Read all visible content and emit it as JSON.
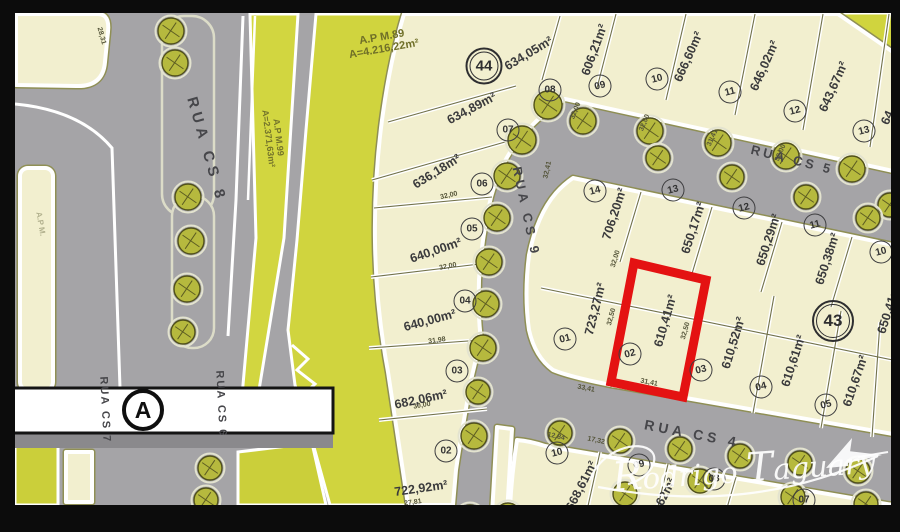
{
  "title": "Loteamento site plan with lot 02 (610,41 m2) highlighted",
  "colors": {
    "paper_cream": "#f2efcf",
    "green_area": "#d0d43e",
    "street_gray": "#a5a4a7",
    "highlight_red": "#e41212",
    "frame_black": "#0c0c0c",
    "tree_olive": "#b6b93e",
    "text_dark": "#3a3a3c"
  },
  "annotations": [
    {
      "id": "ap-m89",
      "lines": [
        "A.P M.89",
        "A=4.216,22m²"
      ],
      "x": 383,
      "y": 44,
      "rot": -10,
      "size": 11,
      "color": "#6f6f28",
      "opacity": 1
    },
    {
      "id": "ap-m99",
      "lines": [
        "A.P M.99",
        "A=2.371,63m²"
      ],
      "x": 273,
      "y": 138,
      "rot": 83,
      "size": 9,
      "color": "#73732b",
      "opacity": 1
    },
    {
      "id": "ap-left",
      "lines": [
        "A.P M."
      ],
      "x": 40,
      "y": 224,
      "rot": 80,
      "size": 8,
      "color": "#7d7d58",
      "opacity": 0.55
    }
  ],
  "streets": [
    {
      "name": "RUA CS 8",
      "x": 206,
      "y": 150,
      "rot": 74,
      "size": 15,
      "ls": 5
    },
    {
      "name": "RUA CS 9",
      "x": 526,
      "y": 212,
      "rot": 78,
      "size": 13,
      "ls": 4
    },
    {
      "name": "RUA CS 5",
      "x": 792,
      "y": 160,
      "rot": 14,
      "size": 13,
      "ls": 3
    },
    {
      "name": "RUA CS 4",
      "x": 692,
      "y": 434,
      "rot": 11,
      "size": 14,
      "ls": 4
    },
    {
      "name": "RUA CS 7",
      "x": 104,
      "y": 410,
      "rot": 87,
      "size": 11,
      "ls": 2
    },
    {
      "name": "RUA CS 6",
      "x": 220,
      "y": 404,
      "rot": 87,
      "size": 11,
      "ls": 2
    }
  ],
  "markers": [
    {
      "label": "44",
      "x": 484,
      "y": 66,
      "d": 37,
      "type": "quadra",
      "font": 15
    },
    {
      "label": "43",
      "x": 833,
      "y": 321,
      "d": 42,
      "type": "quadra",
      "font": 17
    },
    {
      "label": "A",
      "x": 143,
      "y": 410,
      "d": 42,
      "type": "section",
      "font": 23
    }
  ],
  "lots": [
    {
      "block": "44",
      "num": "02",
      "cx": 446,
      "cy": 451,
      "area": "722,92m²",
      "ax": 421,
      "ay": 489,
      "arot": -8
    },
    {
      "block": "44",
      "num": "03",
      "cx": 457,
      "cy": 371,
      "area": "682,06m²",
      "ax": 421,
      "ay": 400,
      "arot": -12
    },
    {
      "block": "44",
      "num": "04",
      "cx": 465,
      "cy": 301,
      "area": "640,00m²",
      "ax": 430,
      "ay": 321,
      "arot": -15
    },
    {
      "block": "44",
      "num": "05",
      "cx": 472,
      "cy": 229,
      "area": "640,00m²",
      "ax": 436,
      "ay": 251,
      "arot": -19
    },
    {
      "block": "44",
      "num": "06",
      "cx": 482,
      "cy": 184,
      "area": "636,18m²",
      "ax": 437,
      "ay": 172,
      "arot": -32
    },
    {
      "block": "44",
      "num": "07",
      "cx": 508,
      "cy": 130,
      "area": "634,89m²",
      "ax": 472,
      "ay": 109,
      "arot": -28
    },
    {
      "block": "44",
      "num": "08",
      "cx": 550,
      "cy": 90,
      "area": "634,05m²",
      "ax": 529,
      "ay": 54,
      "arot": -31
    },
    {
      "block": "44",
      "num": "09",
      "cx": 600,
      "cy": 86,
      "area": "606,21m²",
      "ax": 595,
      "ay": 50,
      "arot": -70
    },
    {
      "block": "44",
      "num": "10",
      "cx": 657,
      "cy": 79,
      "area": "666,60m²",
      "ax": 689,
      "ay": 57,
      "arot": -66
    },
    {
      "block": "44",
      "num": "11",
      "cx": 730,
      "cy": 92,
      "area": "646,02m²",
      "ax": 765,
      "ay": 66,
      "arot": -66
    },
    {
      "block": "44",
      "num": "12",
      "cx": 795,
      "cy": 111,
      "area": "643,67m²",
      "ax": 834,
      "ay": 87,
      "arot": -66
    },
    {
      "block": "44",
      "num": "13",
      "cx": 864,
      "cy": 131,
      "area": "64",
      "ax": 888,
      "ay": 118,
      "arot": -66
    },
    {
      "block": "43",
      "num": "14",
      "cx": 595,
      "cy": 191,
      "area": "706,20m²",
      "ax": 615,
      "ay": 214,
      "arot": -72
    },
    {
      "block": "43",
      "num": "13",
      "cx": 673,
      "cy": 190,
      "area": "650,17m²",
      "ax": 694,
      "ay": 228,
      "arot": -72
    },
    {
      "block": "43",
      "num": "12",
      "cx": 744,
      "cy": 208,
      "area": "650,29m²",
      "ax": 769,
      "ay": 240,
      "arot": -72
    },
    {
      "block": "43",
      "num": "11",
      "cx": 815,
      "cy": 225,
      "area": "650,38m²",
      "ax": 828,
      "ay": 259,
      "arot": -72
    },
    {
      "block": "43",
      "num": "10",
      "cx": 881,
      "cy": 252,
      "area": "650,41m²",
      "ax": 890,
      "ay": 308,
      "arot": -72
    },
    {
      "block": "43",
      "num": "01",
      "cx": 565,
      "cy": 339,
      "area": "723,27m²",
      "ax": 596,
      "ay": 309,
      "arot": -76
    },
    {
      "block": "43",
      "num": "02",
      "cx": 630,
      "cy": 354,
      "area": "610,41m²",
      "ax": 666,
      "ay": 321,
      "arot": -74,
      "highlighted": true
    },
    {
      "block": "43",
      "num": "03",
      "cx": 701,
      "cy": 370,
      "area": "610,52m²",
      "ax": 734,
      "ay": 343,
      "arot": -73
    },
    {
      "block": "43",
      "num": "04",
      "cx": 761,
      "cy": 387,
      "area": "610,61m²",
      "ax": 794,
      "ay": 361,
      "arot": -72
    },
    {
      "block": "43",
      "num": "05",
      "cx": 826,
      "cy": 405,
      "area": "610,67m²",
      "ax": 856,
      "ay": 381,
      "arot": -71
    },
    {
      "block": "",
      "num": "10",
      "cx": 557,
      "cy": 453,
      "area": "668,61m²",
      "ax": 582,
      "ay": 486,
      "arot": -63
    },
    {
      "block": "",
      "num": "09",
      "cx": 639,
      "cy": 465,
      "area": "629,62m²",
      "ax": 661,
      "ay": 503,
      "arot": -63
    },
    {
      "block": "",
      "num": "08",
      "cx": 714,
      "cy": 479
    },
    {
      "block": "",
      "num": "07",
      "cx": 804,
      "cy": 500
    }
  ],
  "dimensions": [
    {
      "v": "28,31",
      "x": 101,
      "y": 36,
      "rot": 75
    },
    {
      "v": "32,00",
      "x": 449,
      "y": 196,
      "rot": -13
    },
    {
      "v": "32,00",
      "x": 448,
      "y": 267,
      "rot": -11
    },
    {
      "v": "31,98",
      "x": 437,
      "y": 341,
      "rot": -8
    },
    {
      "v": "30,00",
      "x": 422,
      "y": 406,
      "rot": -10
    },
    {
      "v": "27,81",
      "x": 413,
      "y": 503,
      "rot": -8
    },
    {
      "v": "32,00",
      "x": 576,
      "y": 111,
      "rot": -68
    },
    {
      "v": "32,00",
      "x": 645,
      "y": 123,
      "rot": -67
    },
    {
      "v": "31,41",
      "x": 713,
      "y": 138,
      "rot": -66
    },
    {
      "v": "32,00",
      "x": 781,
      "y": 153,
      "rot": -66
    },
    {
      "v": "32,41",
      "x": 548,
      "y": 170,
      "rot": -77
    },
    {
      "v": "32,00",
      "x": 616,
      "y": 259,
      "rot": -73
    },
    {
      "v": "32,50",
      "x": 612,
      "y": 317,
      "rot": -75
    },
    {
      "v": "32,50",
      "x": 686,
      "y": 331,
      "rot": -74
    },
    {
      "v": "33,41",
      "x": 586,
      "y": 389,
      "rot": 11
    },
    {
      "v": "31,41",
      "x": 649,
      "y": 383,
      "rot": 11
    },
    {
      "v": "12,84",
      "x": 556,
      "y": 437,
      "rot": 12
    },
    {
      "v": "17,32",
      "x": 596,
      "y": 441,
      "rot": 12
    }
  ],
  "highlight": {
    "lot": "02",
    "area": "610,41m²",
    "color": "#e41212",
    "points": "611,382 634,263 706,280 683,397"
  },
  "trees": [
    {
      "x": 171,
      "y": 31,
      "r": 13
    },
    {
      "x": 175,
      "y": 63,
      "r": 13
    },
    {
      "x": 188,
      "y": 197,
      "r": 13
    },
    {
      "x": 191,
      "y": 241,
      "r": 13
    },
    {
      "x": 187,
      "y": 289,
      "r": 13
    },
    {
      "x": 183,
      "y": 332,
      "r": 12
    },
    {
      "x": 210,
      "y": 468,
      "r": 12
    },
    {
      "x": 206,
      "y": 500,
      "r": 12
    },
    {
      "x": 474,
      "y": 436,
      "r": 13
    },
    {
      "x": 470,
      "y": 518,
      "r": 13
    },
    {
      "x": 508,
      "y": 515,
      "r": 12
    },
    {
      "x": 548,
      "y": 105,
      "r": 14
    },
    {
      "x": 522,
      "y": 140,
      "r": 14
    },
    {
      "x": 507,
      "y": 176,
      "r": 13
    },
    {
      "x": 497,
      "y": 218,
      "r": 13
    },
    {
      "x": 489,
      "y": 262,
      "r": 13
    },
    {
      "x": 486,
      "y": 304,
      "r": 13
    },
    {
      "x": 483,
      "y": 348,
      "r": 13
    },
    {
      "x": 478,
      "y": 392,
      "r": 12
    },
    {
      "x": 583,
      "y": 121,
      "r": 13
    },
    {
      "x": 650,
      "y": 131,
      "r": 13
    },
    {
      "x": 718,
      "y": 143,
      "r": 13
    },
    {
      "x": 786,
      "y": 156,
      "r": 13
    },
    {
      "x": 852,
      "y": 169,
      "r": 13
    },
    {
      "x": 890,
      "y": 205,
      "r": 12
    },
    {
      "x": 658,
      "y": 158,
      "r": 12
    },
    {
      "x": 732,
      "y": 177,
      "r": 12
    },
    {
      "x": 806,
      "y": 197,
      "r": 12
    },
    {
      "x": 868,
      "y": 218,
      "r": 12
    },
    {
      "x": 560,
      "y": 433,
      "r": 12
    },
    {
      "x": 620,
      "y": 441,
      "r": 12
    },
    {
      "x": 680,
      "y": 449,
      "r": 12
    },
    {
      "x": 740,
      "y": 456,
      "r": 12
    },
    {
      "x": 800,
      "y": 463,
      "r": 12
    },
    {
      "x": 858,
      "y": 471,
      "r": 12
    },
    {
      "x": 625,
      "y": 494,
      "r": 12
    },
    {
      "x": 700,
      "y": 481,
      "r": 12
    },
    {
      "x": 793,
      "y": 497,
      "r": 12
    },
    {
      "x": 866,
      "y": 504,
      "r": 12
    }
  ],
  "watermark": {
    "text": "Rodrigo Taguary",
    "parts": [
      [
        "R",
        40
      ],
      [
        "odrigo ",
        29
      ],
      [
        "T",
        40
      ],
      [
        "aguary",
        29
      ]
    ]
  }
}
